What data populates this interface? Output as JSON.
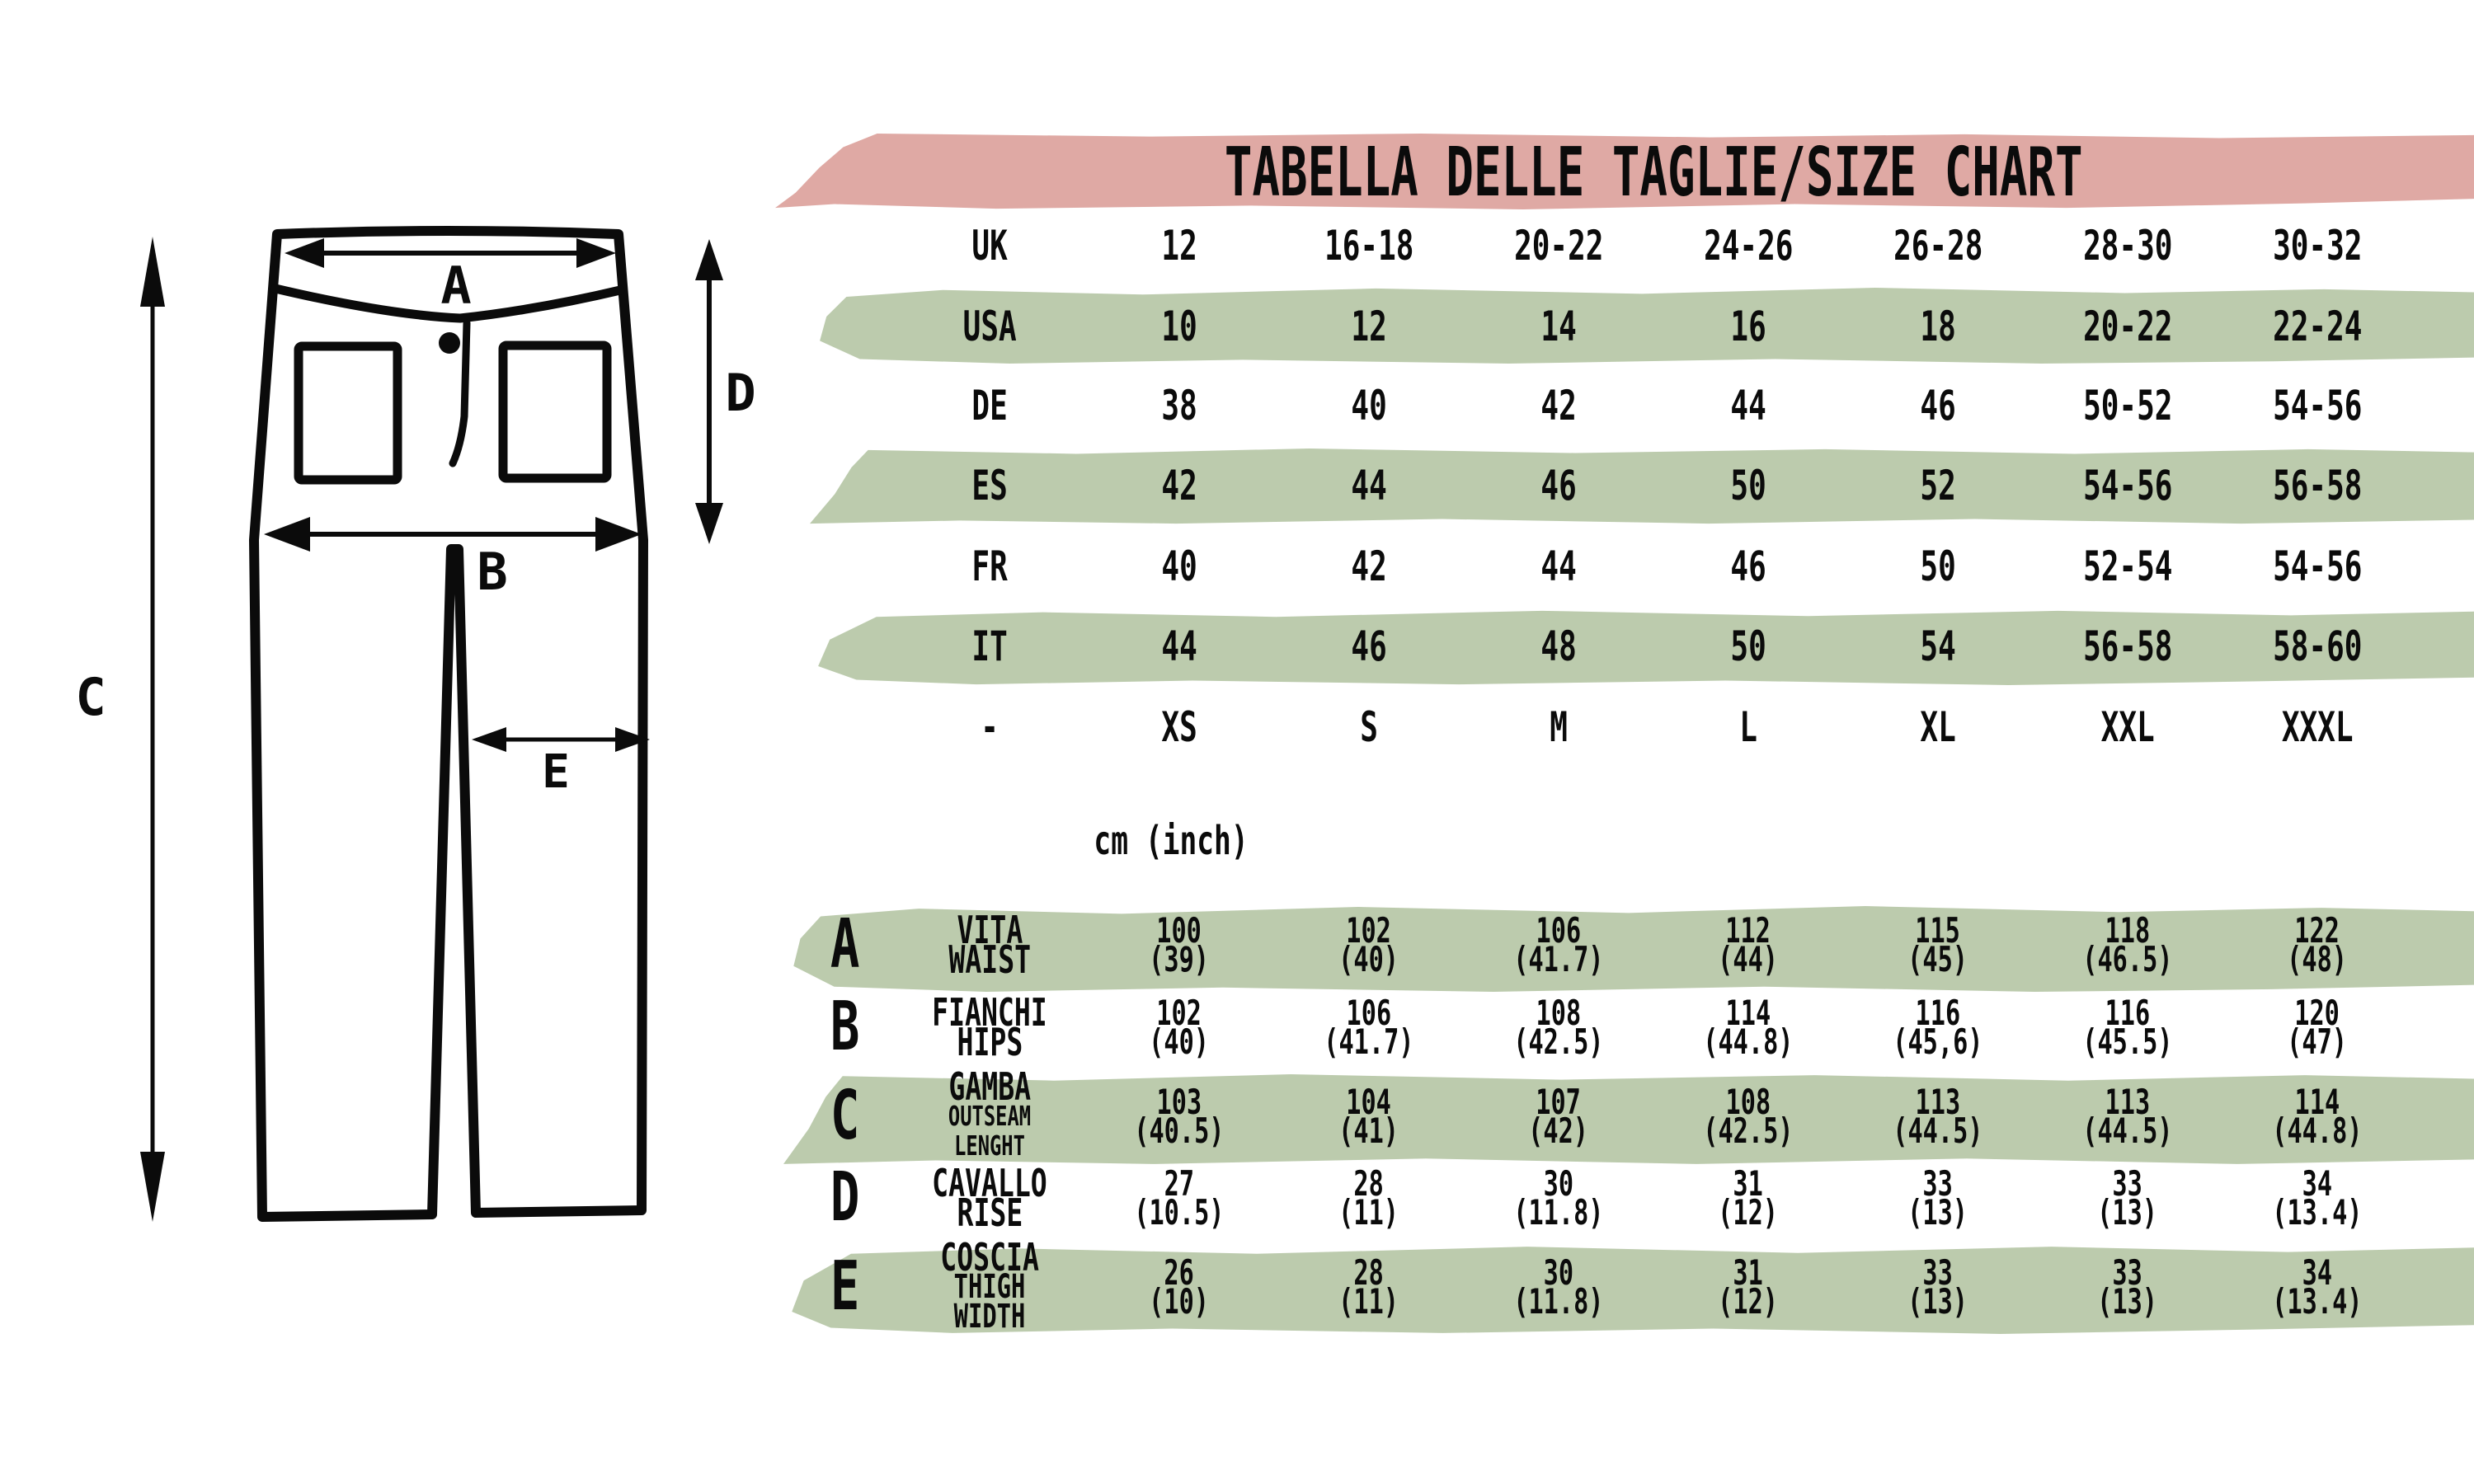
{
  "title": "TABELLA DELLE TAGLIE/SIZE CHART",
  "units_label": "cm (inch)",
  "colors": {
    "band_pink": "#DFA9A4",
    "band_green": "#BCCBAD",
    "ink": "#0B0B0B"
  },
  "diagram": {
    "labels": {
      "a": "A",
      "b": "B",
      "c": "C",
      "d": "D",
      "e": "E"
    }
  },
  "size_table": {
    "rows": [
      {
        "label": "UK",
        "values": [
          "12",
          "16-18",
          "20-22",
          "24-26",
          "26-28",
          "28-30",
          "30-32"
        ]
      },
      {
        "label": "USA",
        "values": [
          "10",
          "12",
          "14",
          "16",
          "18",
          "20-22",
          "22-24"
        ]
      },
      {
        "label": "DE",
        "values": [
          "38",
          "40",
          "42",
          "44",
          "46",
          "50-52",
          "54-56"
        ]
      },
      {
        "label": "ES",
        "values": [
          "42",
          "44",
          "46",
          "50",
          "52",
          "54-56",
          "56-58"
        ]
      },
      {
        "label": "FR",
        "values": [
          "40",
          "42",
          "44",
          "46",
          "50",
          "52-54",
          "54-56"
        ]
      },
      {
        "label": "IT",
        "values": [
          "44",
          "46",
          "48",
          "50",
          "54",
          "56-58",
          "58-60"
        ]
      },
      {
        "label": "-",
        "values": [
          "XS",
          "S",
          "M",
          "L",
          "XL",
          "XXL",
          "XXXL"
        ]
      }
    ]
  },
  "measurements": {
    "rows": [
      {
        "letter": "A",
        "name_it": "VITA",
        "name_en": "WAIST",
        "values": [
          "100\n(39)",
          "102\n(40)",
          "106\n(41.7)",
          "112\n(44)",
          "115\n(45)",
          "118\n(46.5)",
          "122\n(48)"
        ]
      },
      {
        "letter": "B",
        "name_it": "FIANCHI",
        "name_en": "HIPS",
        "values": [
          "102\n(40)",
          "106\n(41.7)",
          "108\n(42.5)",
          "114\n(44.8)",
          "116\n(45,6)",
          "116\n(45.5)",
          "120\n(47)"
        ]
      },
      {
        "letter": "C",
        "name_it": "GAMBA",
        "name_en": "OUTSEAM LENGHT",
        "values": [
          "103\n(40.5)",
          "104\n(41)",
          "107\n(42)",
          "108\n(42.5)",
          "113\n(44.5)",
          "113\n(44.5)",
          "114\n(44.8)"
        ]
      },
      {
        "letter": "D",
        "name_it": "CAVALLO",
        "name_en": "RISE",
        "values": [
          "27\n(10.5)",
          "28\n(11)",
          "30\n(11.8)",
          "31\n(12)",
          "33\n(13)",
          "33\n(13)",
          "34\n(13.4)"
        ]
      },
      {
        "letter": "E",
        "name_it": "COSCIA",
        "name_en": "THIGH WIDTH",
        "values": [
          "26\n(10)",
          "28\n(11)",
          "30\n(11.8)",
          "31\n(12)",
          "33\n(13)",
          "33\n(13)",
          "34\n(13.4)"
        ]
      }
    ]
  }
}
